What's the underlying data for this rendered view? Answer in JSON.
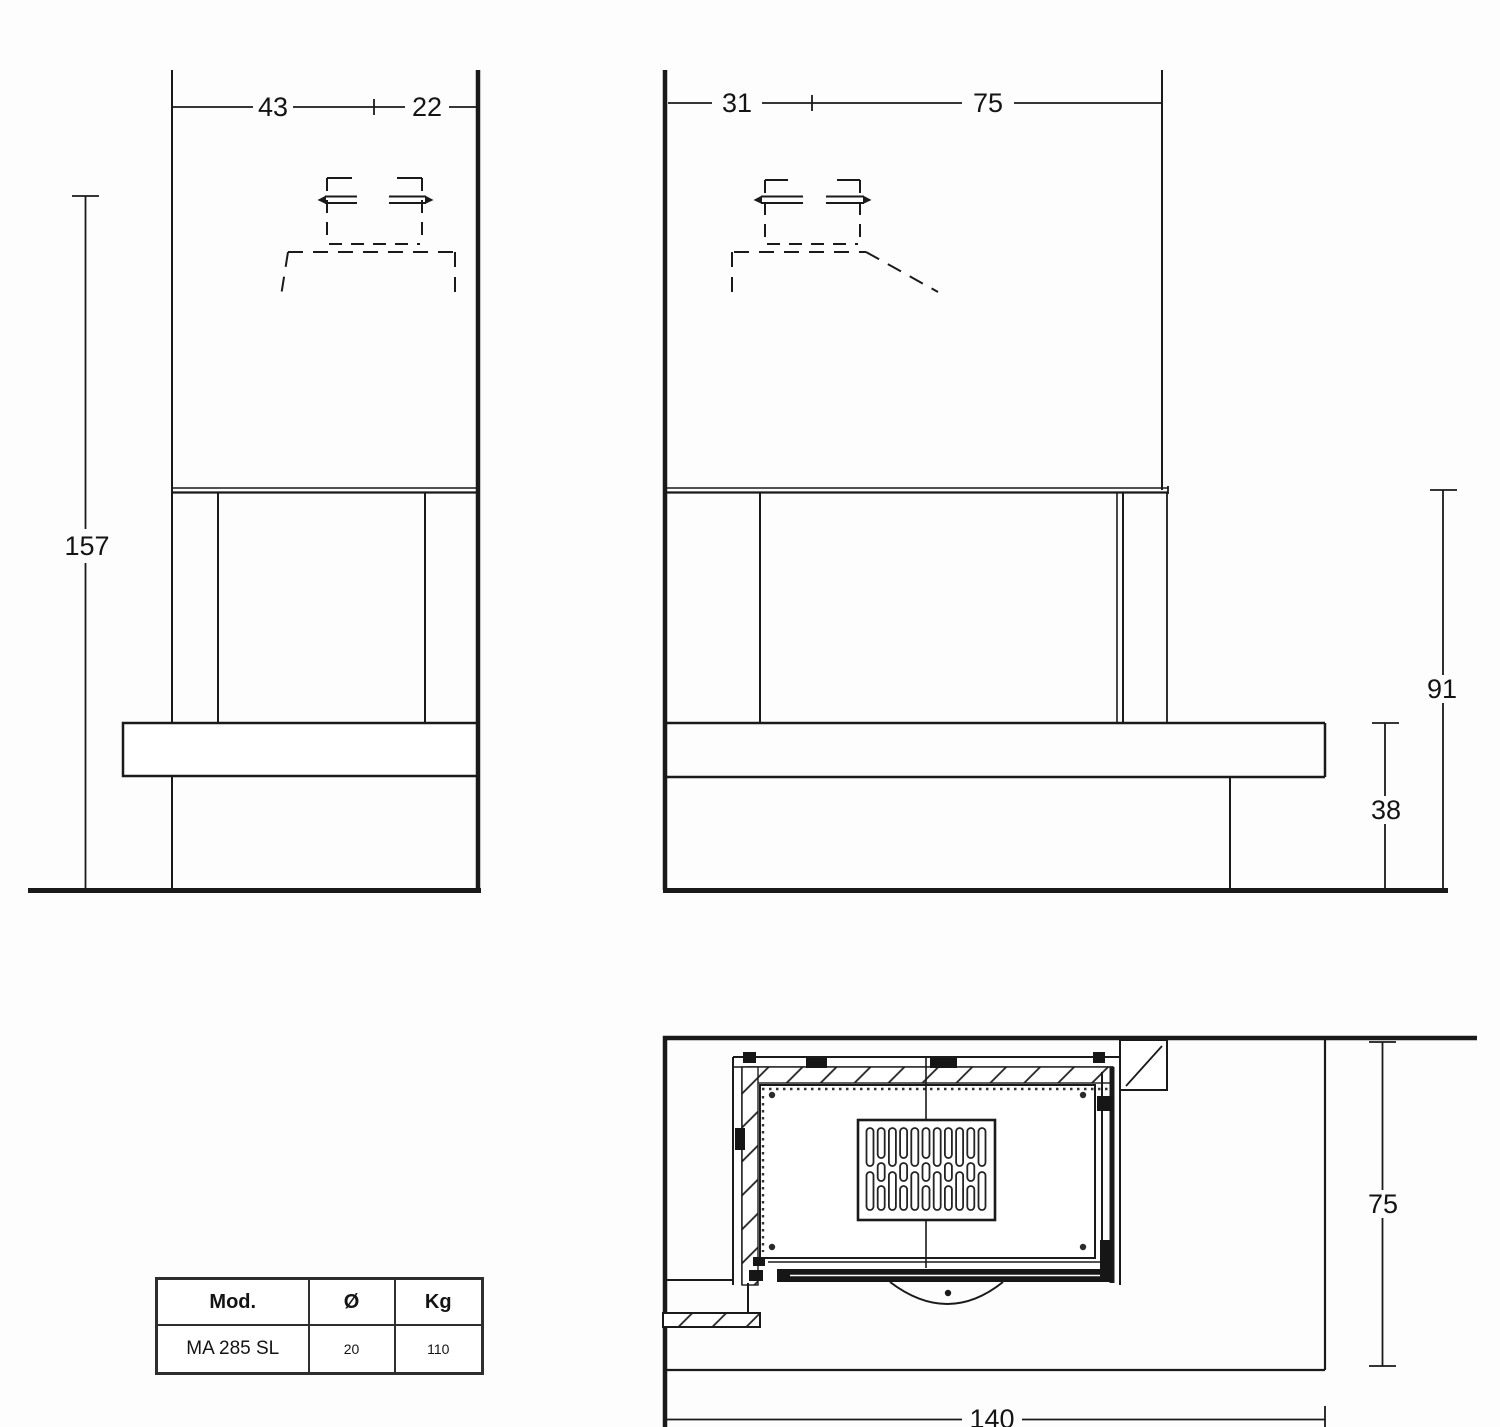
{
  "front_view": {
    "width_inner": "43",
    "width_side": "22",
    "height_total": "157"
  },
  "side_view": {
    "depth_front": "31",
    "depth_back": "75",
    "height_opening": "91",
    "height_bench": "38"
  },
  "top_view": {
    "depth": "75",
    "width": "140"
  },
  "spec_table": {
    "headers": {
      "model": "Mod.",
      "diameter": "Ø",
      "weight": "Kg"
    },
    "row": {
      "model": "MA 285 SL",
      "diameter": "20",
      "weight": "110"
    }
  }
}
